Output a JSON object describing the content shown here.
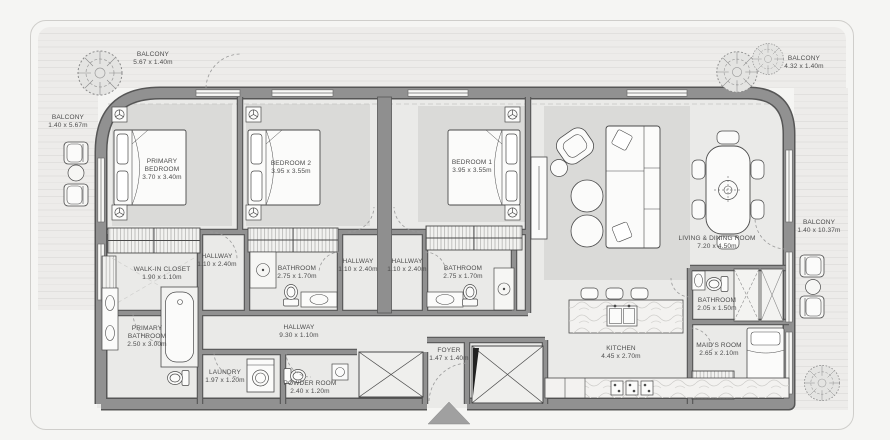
{
  "plan": {
    "balconies": [
      {
        "name": "BALCONY",
        "dims": "5.67 x 1.40m"
      },
      {
        "name": "BALCONY",
        "dims": "1.40 x 5.67m"
      },
      {
        "name": "BALCONY",
        "dims": "4.32 x 1.40m"
      },
      {
        "name": "BALCONY",
        "dims": "1.40 x 10.37m"
      }
    ],
    "rooms": [
      {
        "name": "PRIMARY BEDROOM",
        "dims": "3.70 x 3.40m"
      },
      {
        "name": "BEDROOM 2",
        "dims": "3.95 x 3.55m"
      },
      {
        "name": "BEDROOM 1",
        "dims": "3.95 x 3.55m"
      },
      {
        "name": "LIVING & DINING ROOM",
        "dims": "7.20 x 4.50m"
      },
      {
        "name": "WALK-IN CLOSET",
        "dims": "1.90 x 1.10m"
      },
      {
        "name": "HALLWAY",
        "dims": "1.10 x 2.40m"
      },
      {
        "name": "BATHROOM",
        "dims": "2.75 x 1.70m"
      },
      {
        "name": "HALLWAY",
        "dims": "1.10 x 2.40m"
      },
      {
        "name": "HALLWAY",
        "dims": "1.10 x 2.40m"
      },
      {
        "name": "BATHROOM",
        "dims": "2.75 x 1.70m"
      },
      {
        "name": "HALLWAY",
        "dims": "9.30 x 1.10m"
      },
      {
        "name": "PRIMARY BATHROOM",
        "dims": "2.50 x 3.00m"
      },
      {
        "name": "LAUNDRY",
        "dims": "1.97 x 1.20m"
      },
      {
        "name": "POWDER ROOM",
        "dims": "2.40 x 1.20m"
      },
      {
        "name": "FOYER",
        "dims": "1.47 x 1.40m"
      },
      {
        "name": "KITCHEN",
        "dims": "4.45 x 2.70m"
      },
      {
        "name": "BATHROOM",
        "dims": "2.05 x 1.50m"
      },
      {
        "name": "MAID'S ROOM",
        "dims": "2.65 x 2.10m"
      }
    ],
    "colors": {
      "wall": "#8f8f8f",
      "wall_edge": "#565656",
      "floor": "#eaeae8",
      "rug": "#dadad8",
      "balcony_deck": "#edecea",
      "label_text": "#4c4c4c",
      "entry_arrow": "#a0a0a0",
      "outline": "#cfcecb"
    }
  }
}
